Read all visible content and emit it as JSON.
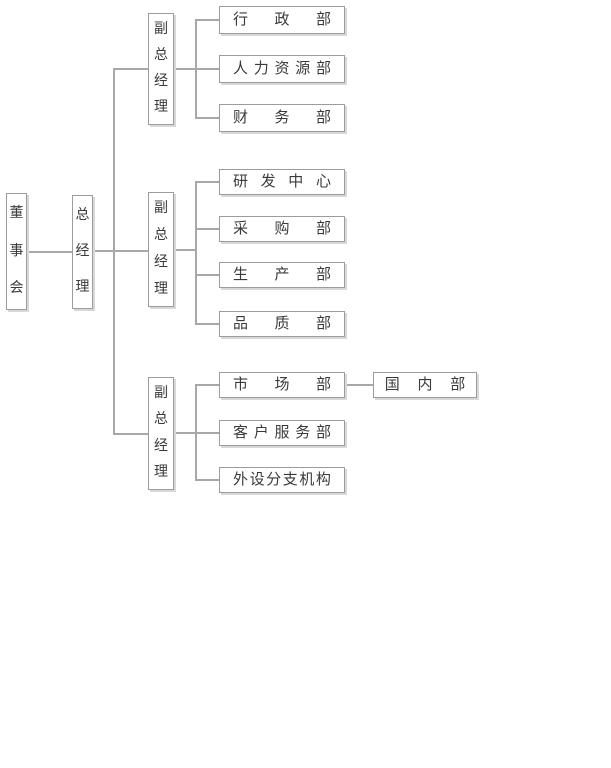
{
  "org": {
    "colors": {
      "background": "#ffffff",
      "line": "#a8a8a8",
      "box_border": "#9c9c9c",
      "text": "#3a3a3a"
    },
    "nodes": {
      "board": {
        "label": "董事会"
      },
      "gm": {
        "label": "总经理"
      },
      "vice1": {
        "label": "副总经理"
      },
      "vice2": {
        "label": "副总经理"
      },
      "vice3": {
        "label": "副总经理"
      },
      "admin": {
        "label": "行政部"
      },
      "hr": {
        "label": "人力资源部"
      },
      "finance": {
        "label": "财务部"
      },
      "rnd": {
        "label": "研发中心"
      },
      "purchasing": {
        "label": "采购部"
      },
      "production": {
        "label": "生产部"
      },
      "quality": {
        "label": "品质部"
      },
      "marketing": {
        "label": "市场部"
      },
      "domestic": {
        "label": "国内部"
      },
      "customer_service": {
        "label": "客户服务部"
      },
      "branches": {
        "label": "外设分支机构"
      }
    },
    "edges": [
      [
        "board",
        "gm"
      ],
      [
        "gm",
        "vice1"
      ],
      [
        "gm",
        "vice2"
      ],
      [
        "gm",
        "vice3"
      ],
      [
        "vice1",
        "admin"
      ],
      [
        "vice1",
        "hr"
      ],
      [
        "vice1",
        "finance"
      ],
      [
        "vice2",
        "rnd"
      ],
      [
        "vice2",
        "purchasing"
      ],
      [
        "vice2",
        "production"
      ],
      [
        "vice2",
        "quality"
      ],
      [
        "vice3",
        "marketing"
      ],
      [
        "vice3",
        "customer_service"
      ],
      [
        "vice3",
        "branches"
      ],
      [
        "marketing",
        "domestic"
      ]
    ]
  }
}
